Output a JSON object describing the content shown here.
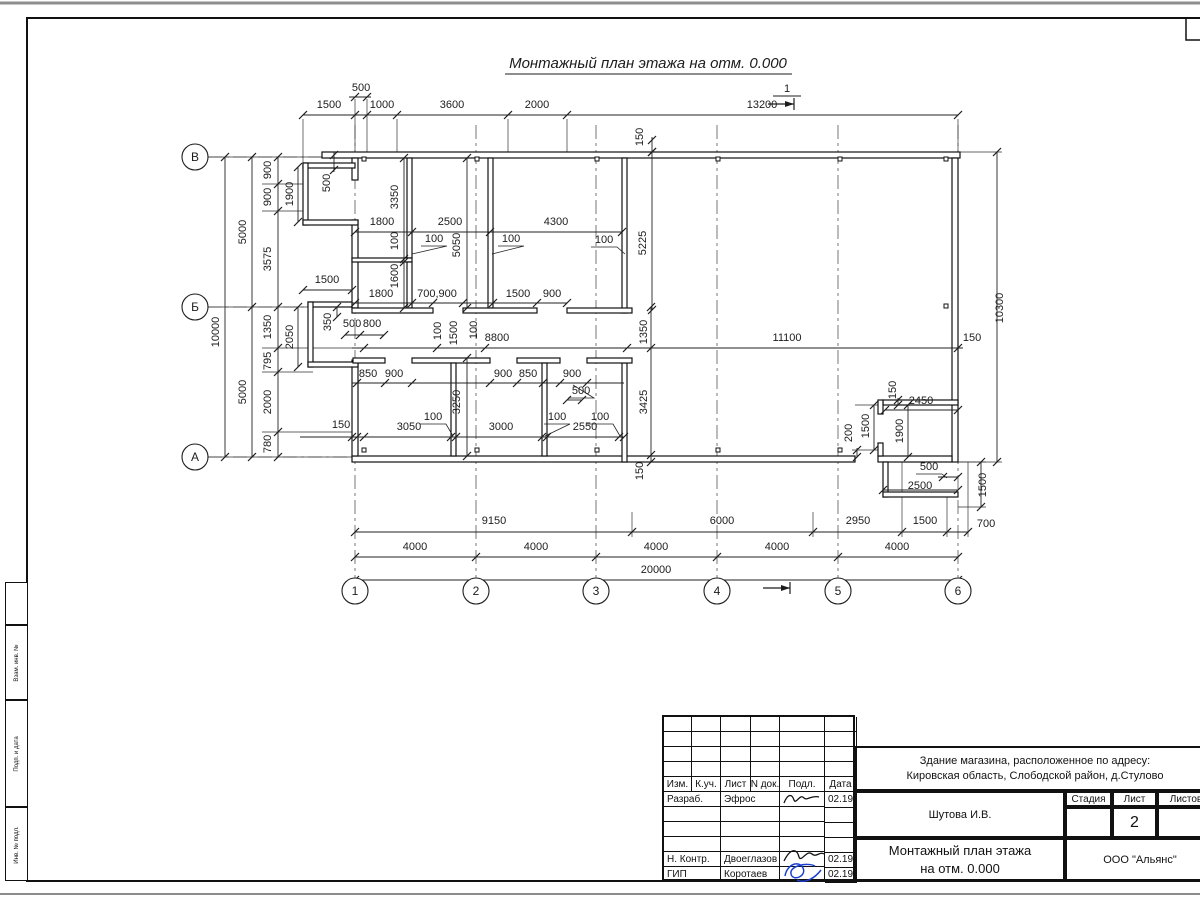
{
  "title": "Монтажный план этажа на отм. 0.000",
  "section_mark": {
    "top_label": "1"
  },
  "axes": {
    "letters": [
      {
        "label": "В",
        "x": 195,
        "y": 157
      },
      {
        "label": "Б",
        "x": 195,
        "y": 307
      },
      {
        "label": "А",
        "x": 195,
        "y": 457
      }
    ],
    "numbers": [
      {
        "label": "1",
        "x": 355,
        "y": 591
      },
      {
        "label": "2",
        "x": 476,
        "y": 591
      },
      {
        "label": "3",
        "x": 596,
        "y": 591
      },
      {
        "label": "4",
        "x": 717,
        "y": 591
      },
      {
        "label": "5",
        "x": 838,
        "y": 591
      },
      {
        "label": "6",
        "x": 958,
        "y": 591
      }
    ]
  },
  "dim_labels": [
    [
      "500",
      361,
      91,
      0
    ],
    [
      "1500",
      329,
      108,
      0
    ],
    [
      "1000",
      382,
      108,
      0
    ],
    [
      "3600",
      452,
      108,
      0
    ],
    [
      "2000",
      537,
      108,
      0
    ],
    [
      "13200",
      762,
      108,
      0
    ],
    [
      "150",
      643,
      137,
      1
    ],
    [
      "10000",
      219,
      332,
      1
    ],
    [
      "5000",
      246,
      232,
      1
    ],
    [
      "5000",
      246,
      392,
      1
    ],
    [
      "900",
      271,
      170,
      1
    ],
    [
      "900",
      271,
      197,
      1
    ],
    [
      "3575",
      271,
      259,
      1
    ],
    [
      "1350",
      271,
      327,
      1
    ],
    [
      "795",
      271,
      361,
      1
    ],
    [
      "2000",
      271,
      402,
      1
    ],
    [
      "780",
      271,
      444,
      1
    ],
    [
      "1900",
      293,
      194,
      1
    ],
    [
      "2050",
      293,
      337,
      1
    ],
    [
      "1500",
      327,
      283,
      0
    ],
    [
      "350",
      331,
      322,
      1
    ],
    [
      "500",
      352,
      327,
      0
    ],
    [
      "800",
      372,
      327,
      0
    ],
    [
      "500",
      330,
      183,
      1
    ],
    [
      "3350",
      398,
      197,
      1
    ],
    [
      "100",
      398,
      241,
      1
    ],
    [
      "1600",
      398,
      276,
      1
    ],
    [
      "1800",
      382,
      225,
      0
    ],
    [
      "2500",
      450,
      225,
      0
    ],
    [
      "4300",
      556,
      225,
      0
    ],
    [
      "100",
      434,
      242,
      0
    ],
    [
      "100",
      511,
      242,
      0
    ],
    [
      "100",
      604,
      243,
      0
    ],
    [
      "5050",
      460,
      245,
      1
    ],
    [
      "5225",
      646,
      243,
      1
    ],
    [
      "1800",
      381,
      297,
      0
    ],
    [
      "700,900",
      437,
      297,
      0
    ],
    [
      "1500",
      518,
      297,
      0
    ],
    [
      "900",
      552,
      297,
      0
    ],
    [
      "100",
      441,
      331,
      1
    ],
    [
      "1500",
      457,
      333,
      1
    ],
    [
      "100",
      477,
      330,
      1
    ],
    [
      "8800",
      497,
      341,
      0
    ],
    [
      "11100",
      787,
      341,
      0
    ],
    [
      "150",
      972,
      341,
      0
    ],
    [
      "1350",
      647,
      332,
      1
    ],
    [
      "3425",
      647,
      402,
      1
    ],
    [
      "150",
      643,
      471,
      1
    ],
    [
      "850",
      368,
      377,
      0
    ],
    [
      "900",
      394,
      377,
      0
    ],
    [
      "900",
      503,
      377,
      0
    ],
    [
      "850",
      528,
      377,
      0
    ],
    [
      "900",
      572,
      377,
      0
    ],
    [
      "500",
      581,
      394,
      0
    ],
    [
      "3250",
      460,
      402,
      1
    ],
    [
      "150",
      341,
      428,
      0
    ],
    [
      "3050",
      409,
      430,
      0
    ],
    [
      "3000",
      501,
      430,
      0
    ],
    [
      "2550",
      585,
      430,
      0
    ],
    [
      "100",
      433,
      420,
      0
    ],
    [
      "100",
      557,
      420,
      0
    ],
    [
      "100",
      600,
      420,
      0
    ],
    [
      "150",
      896,
      390,
      1
    ],
    [
      "2450",
      921,
      404,
      0
    ],
    [
      "1900",
      903,
      431,
      1
    ],
    [
      "1500",
      869,
      426,
      1
    ],
    [
      "200",
      852,
      433,
      1
    ],
    [
      "500",
      929,
      470,
      0
    ],
    [
      "2500",
      920,
      489,
      0
    ],
    [
      "1500",
      986,
      485,
      1
    ],
    [
      "10300",
      1003,
      308,
      1
    ],
    [
      "9150",
      494,
      524,
      0
    ],
    [
      "6000",
      722,
      524,
      0
    ],
    [
      "2950",
      858,
      524,
      0
    ],
    [
      "1500",
      925,
      524,
      0
    ],
    [
      "700",
      986,
      527,
      0
    ],
    [
      "4000",
      415,
      550,
      0
    ],
    [
      "4000",
      536,
      550,
      0
    ],
    [
      "4000",
      656,
      550,
      0
    ],
    [
      "4000",
      777,
      550,
      0
    ],
    [
      "4000",
      897,
      550,
      0
    ],
    [
      "20000",
      656,
      573,
      0
    ]
  ],
  "title_block": {
    "header_cols": [
      "Изм.",
      "К.уч.",
      "Лист",
      "N док.",
      "Подл.",
      "Дата"
    ],
    "rows": [
      [
        "Разраб.",
        "Эфрос",
        "02.19"
      ],
      [
        "",
        "",
        ""
      ],
      [
        "",
        "",
        ""
      ],
      [
        "",
        "",
        ""
      ],
      [
        "Н. Контр.",
        "Двоеглазов",
        "02.19"
      ],
      [
        "ГИП",
        "Коротаев",
        "02.19"
      ]
    ],
    "project_line1": "Здание магазина, расположенное по адресу:",
    "project_line2": "Кировская область, Слободской район, д.Стулово",
    "author": "Шутова И.В.",
    "stage_label": "Стадия",
    "sheet_label": "Лист",
    "sheets_label": "Листов",
    "sheet_number": "2",
    "doc_title_line1": "Монтажный план этажа",
    "doc_title_line2": "на отм. 0.000",
    "company": "ООО \"Альянс\""
  },
  "frame": {
    "side_labels": [
      "Взам. инв. №",
      "Подп. и дата",
      "Инв. № подл."
    ]
  },
  "colors": {
    "line": "#1c1c1c",
    "signature_blue": "#1b3fd0",
    "frame_gray": "#8e8e8e"
  }
}
